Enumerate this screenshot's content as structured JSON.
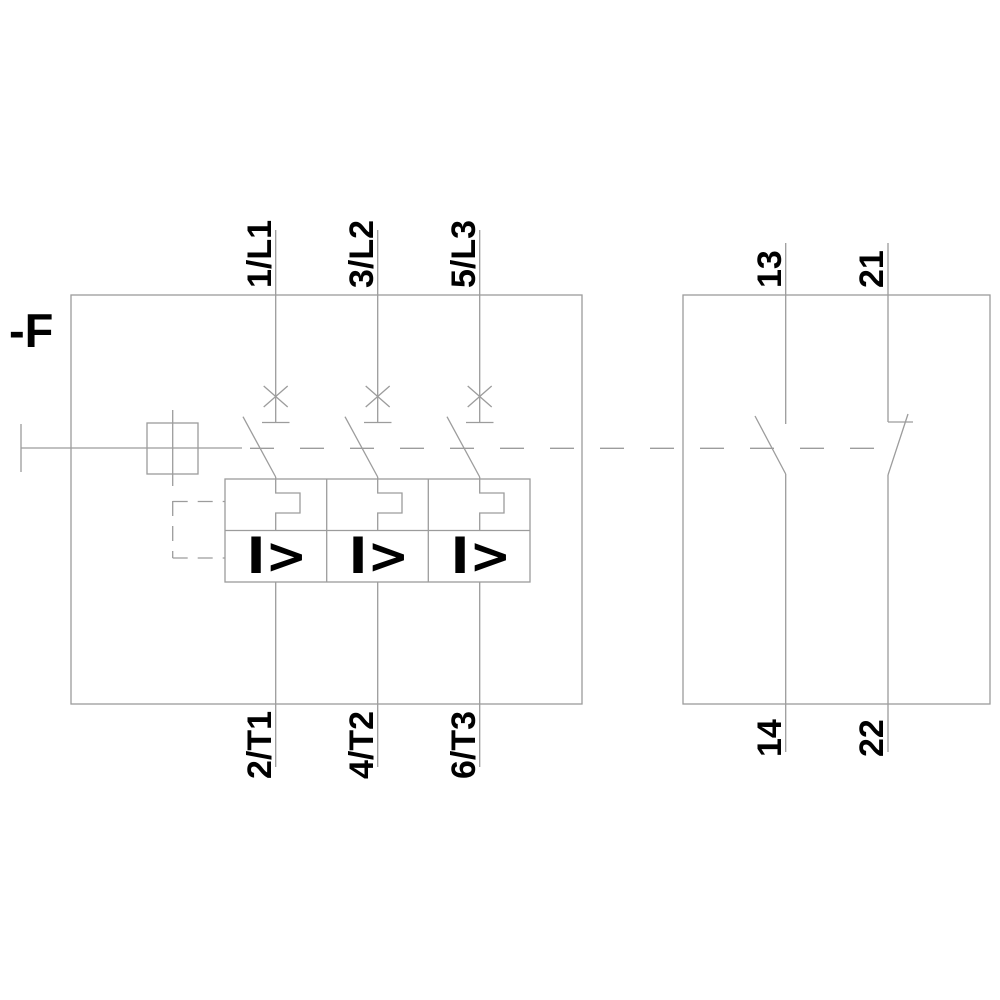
{
  "schematic": {
    "device_designator": "-F",
    "poles": [
      {
        "line_terminal": "1/L1",
        "load_terminal": "2/T1",
        "overcurrent_symbol": "I>"
      },
      {
        "line_terminal": "3/L2",
        "load_terminal": "4/T2",
        "overcurrent_symbol": "I>"
      },
      {
        "line_terminal": "5/L3",
        "load_terminal": "6/T3",
        "overcurrent_symbol": "I>"
      }
    ],
    "aux_contacts": [
      {
        "top_terminal": "13",
        "bottom_terminal": "14",
        "contact_type": "normally-open"
      },
      {
        "top_terminal": "21",
        "bottom_terminal": "22",
        "contact_type": "normally-closed"
      }
    ],
    "colors": {
      "line": "#9c9c9c",
      "text": "#000000",
      "background": "#ffffff"
    }
  }
}
